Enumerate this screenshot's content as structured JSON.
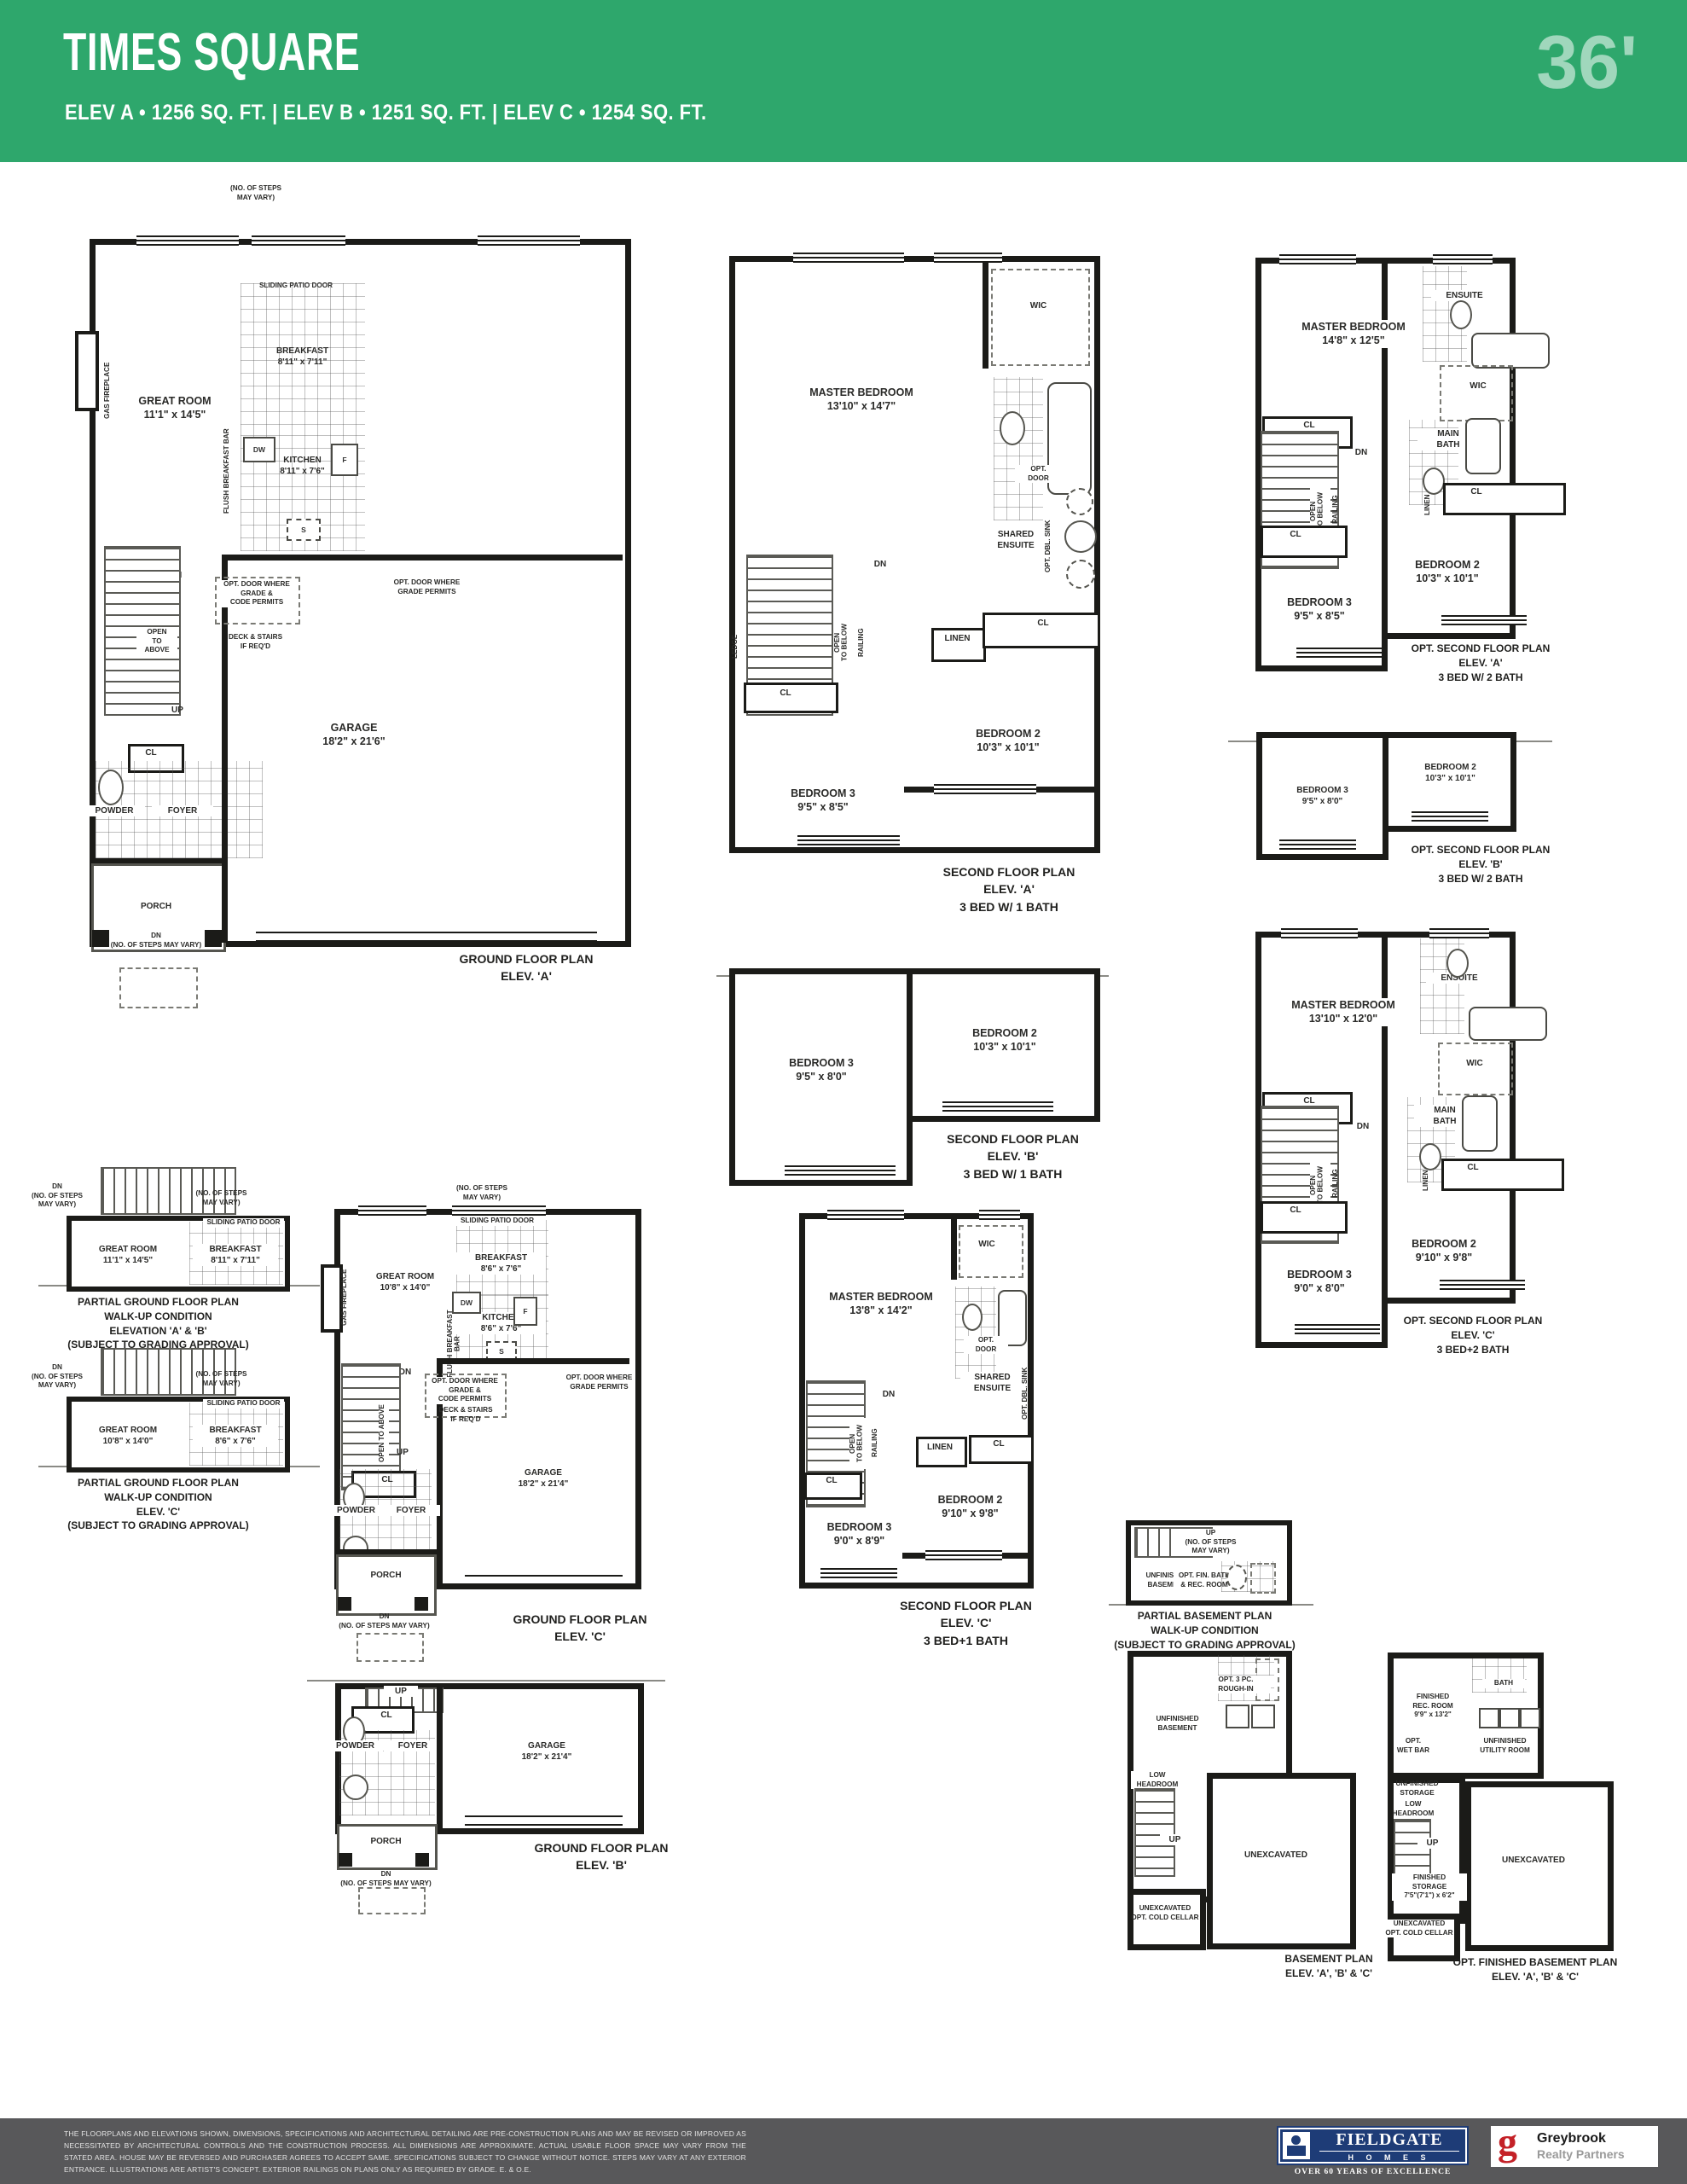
{
  "header": {
    "title": "TIMES SQUARE",
    "subtitle": "ELEV A  • 1256 SQ. FT.  |  ELEV B  • 1251 SQ. FT.  |  ELEV C  • 1254 SQ. FT.",
    "width_tag": "36'"
  },
  "colors": {
    "header_green": "#2ea76c",
    "footer_gray": "#58585a",
    "fieldgate_blue": "#1e3c77",
    "greybrook_red": "#c42127",
    "plan_wall": "#1b1b18"
  },
  "common": {
    "cl": "CL",
    "dn": "DN",
    "up": "UP",
    "wic": "WIC",
    "linen": "LINEN",
    "ledge": "LEDGE",
    "railing": "RAILING",
    "open_below": "OPEN\nTO BELOW",
    "open_above": "OPEN\nTO\nABOVE",
    "open_above_v": "OPEN TO ABOVE",
    "dw": "DW",
    "f": "F",
    "s": "S",
    "powder": "POWDER",
    "foyer": "FOYER",
    "porch": "PORCH",
    "gas_fireplace": "GAS FIREPLACE",
    "flush_bar": "FLUSH BREAKFAST BAR",
    "sliding_patio": "SLIDING PATIO DOOR",
    "steps_vary": "(NO. OF STEPS\nMAY VARY)",
    "dn_steps": "DN\n(NO. OF STEPS MAY VARY)",
    "dn_steps_3": "DN\n(NO. OF STEPS\nMAY VARY)",
    "up_steps": "UP\n(NO. OF STEPS\nMAY VARY)",
    "opt_door_grade_code": "OPT. DOOR WHERE\nGRADE &\nCODE PERMITS",
    "opt_door_grade": "OPT. DOOR WHERE\nGRADE PERMITS",
    "deck_stairs": "DECK & STAIRS\nIF REQ'D",
    "shared_ensuite": "SHARED\nENSUITE",
    "opt_door": "OPT.\nDOOR",
    "opt_dbl_sink": "OPT. DBL. SINK",
    "ensuite": "ENSUITE",
    "main_bath": "MAIN\nBATH",
    "bath": "BATH",
    "low_headroom": "LOW\nHEADROOM",
    "unexcavated": "UNEXCAVATED",
    "unfinished_basement": "UNFINISHED\nBASEMENT",
    "unexc_cold": "UNEXCAVATED\nOPT. COLD CELLAR",
    "rough_in": "OPT. 3 PC.\nROUGH-IN"
  },
  "plans": {
    "ground_a": {
      "caption": "GROUND FLOOR PLAN\nELEV. 'A'",
      "great_room": "GREAT ROOM\n11'1\" x 14'5\"",
      "breakfast": "BREAKFAST\n8'11\" x 7'11\"",
      "kitchen": "KITCHEN\n8'11\" x 7'6\"",
      "garage": "GARAGE\n18'2\" x 21'6\""
    },
    "second_a": {
      "caption": "SECOND FLOOR PLAN\nELEV. 'A'\n3 BED W/ 1 BATH",
      "master": "MASTER BEDROOM\n13'10\" x 14'7\"",
      "bed2": "BEDROOM 2\n10'3\" x 10'1\"",
      "bed3": "BEDROOM 3\n9'5\" x 8'5\""
    },
    "second_b": {
      "caption": "SECOND FLOOR PLAN\nELEV. 'B'\n3 BED W/ 1 BATH",
      "bed2": "BEDROOM 2\n10'3\" x 10'1\"",
      "bed3": "BEDROOM 3\n9'5\" x 8'0\""
    },
    "opt_second_a": {
      "caption": "OPT. SECOND FLOOR PLAN\nELEV. 'A'\n3 BED W/ 2 BATH",
      "master": "MASTER BEDROOM\n14'8\" x 12'5\"",
      "bed2": "BEDROOM 2\n10'3\" x 10'1\"",
      "bed3": "BEDROOM 3\n9'5\" x 8'5\""
    },
    "opt_second_b": {
      "caption": "OPT. SECOND FLOOR PLAN\nELEV. 'B'\n3 BED W/ 2 BATH",
      "bed2": "BEDROOM 2\n10'3\" x 10'1\"",
      "bed3": "BEDROOM 3\n9'5\" x 8'0\""
    },
    "opt_second_c": {
      "caption": "OPT. SECOND FLOOR PLAN\nELEV. 'C'\n3 BED+2 BATH",
      "master": "MASTER BEDROOM\n13'10\" x 12'0\"",
      "bed2": "BEDROOM 2\n9'10\" x 9'8\"",
      "bed3": "BEDROOM 3\n9'0\" x 8'0\""
    },
    "partial_ab": {
      "caption": "PARTIAL GROUND FLOOR PLAN\nWALK-UP CONDITION\nELEVATION 'A' & 'B'\n(SUBJECT TO GRADING APPROVAL)",
      "great_room": "GREAT ROOM\n11'1\" x 14'5\"",
      "breakfast": "BREAKFAST\n8'11\" x 7'11\""
    },
    "partial_c": {
      "caption": "PARTIAL GROUND FLOOR PLAN\nWALK-UP CONDITION\nELEV. 'C'\n(SUBJECT TO GRADING APPROVAL)",
      "great_room": "GREAT ROOM\n10'8\" x 14'0\"",
      "breakfast": "BREAKFAST\n8'6\" x 7'6\""
    },
    "ground_c": {
      "caption": "GROUND FLOOR PLAN\nELEV. 'C'",
      "great_room": "GREAT ROOM\n10'8\" x 14'0\"",
      "breakfast": "BREAKFAST\n8'6\" x 7'6\"",
      "kitchen": "KITCHEN\n8'6\" x 7'6\"",
      "garage": "GARAGE\n18'2\" x 21'4\""
    },
    "second_c": {
      "caption": "SECOND FLOOR PLAN\nELEV. 'C'\n3 BED+1 BATH",
      "master": "MASTER BEDROOM\n13'8\" x 14'2\"",
      "bed2": "BEDROOM 2\n9'10\" x 9'8\"",
      "bed3": "BEDROOM 3\n9'0\" x 8'9\""
    },
    "ground_b": {
      "caption": "GROUND FLOOR PLAN\nELEV. 'B'",
      "garage": "GARAGE\n18'2\" x 21'4\""
    },
    "partial_bsmt": {
      "caption": "PARTIAL BASEMENT PLAN\nWALK-UP CONDITION\n(SUBJECT TO GRADING APPROVAL)",
      "rec": "OPT. FIN. BATH\n& REC. ROOM"
    },
    "bsmt": {
      "caption": "BASEMENT PLAN\nELEV. 'A', 'B' & 'C'"
    },
    "opt_bsmt": {
      "caption": "OPT. FINISHED BASEMENT PLAN\nELEV. 'A', 'B' & 'C'",
      "rec": "FINISHED\nREC. ROOM\n9'9\" x 13'2\"",
      "utility": "UNFINISHED\nUTILITY ROOM",
      "wet_bar": "OPT.\nWET BAR",
      "unf_storage": "UNFINISHED\nSTORAGE",
      "fin_storage": "FINISHED\nSTORAGE\n7'5\"(7'1\") x 6'2\""
    }
  },
  "footer": {
    "disclaimer": "THE FLOORPLANS AND ELEVATIONS SHOWN, DIMENSIONS, SPECIFICATIONS AND ARCHITECTURAL DETAILING ARE PRE-CONSTRUCTION PLANS AND MAY BE REVISED OR IMPROVED AS NECESSITATED BY ARCHITECTURAL CONTROLS AND THE CONSTRUCTION PROCESS. ALL DIMENSIONS ARE APPROXIMATE. ACTUAL USABLE FLOOR SPACE MAY VARY FROM THE STATED AREA. HOUSE MAY BE REVERSED AND PURCHASER AGREES TO ACCEPT SAME. SPECIFICATIONS SUBJECT TO CHANGE WITHOUT NOTICE. STEPS MAY VARY AT ANY EXTERIOR ENTRANCE. ILLUSTRATIONS ARE ARTIST'S CONCEPT. EXTERIOR RAILINGS ON PLANS ONLY AS REQUIRED BY GRADE. E. & O.E.",
    "fieldgate": {
      "name": "FIELDGATE",
      "homes": "H O M E S",
      "tagline": "OVER 60 YEARS OF EXCELLENCE"
    },
    "greybrook": {
      "mark": "g",
      "name": "Greybrook",
      "subname": "Realty Partners"
    }
  }
}
